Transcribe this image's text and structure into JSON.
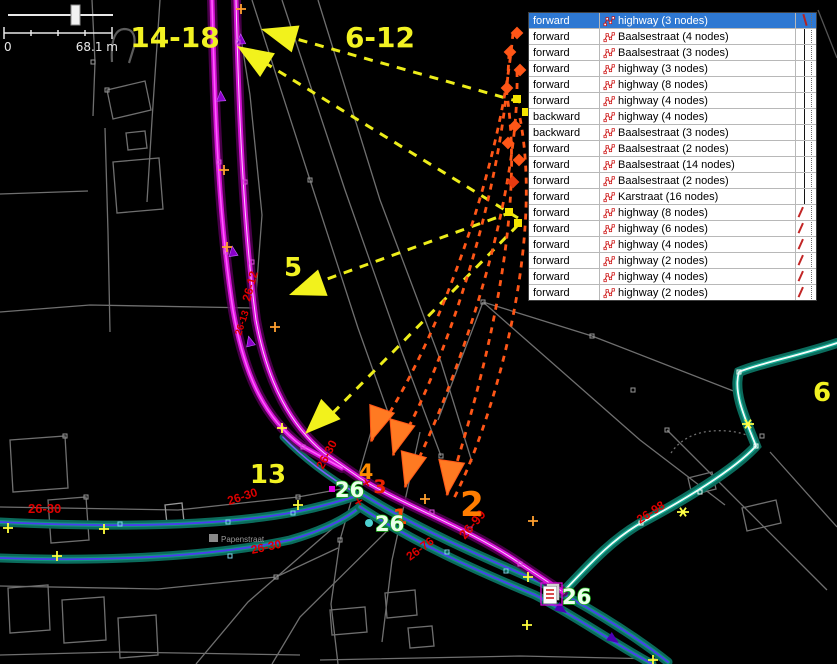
{
  "panel": {
    "rows": [
      {
        "role": "forward",
        "name": "highway (3 nodes)",
        "selected": true,
        "conn": "red"
      },
      {
        "role": "forward",
        "name": "Baalsestraat (4 nodes)",
        "selected": false,
        "conn": "v"
      },
      {
        "role": "forward",
        "name": "Baalsestraat (3 nodes)",
        "selected": false,
        "conn": "v"
      },
      {
        "role": "forward",
        "name": "highway (3 nodes)",
        "selected": false,
        "conn": "v"
      },
      {
        "role": "forward",
        "name": "highway (8 nodes)",
        "selected": false,
        "conn": "v"
      },
      {
        "role": "forward",
        "name": "highway (4 nodes)",
        "selected": false,
        "conn": "v"
      },
      {
        "role": "backward",
        "name": "highway (4 nodes)",
        "selected": false,
        "conn": "v"
      },
      {
        "role": "backward",
        "name": "Baalsestraat (3 nodes)",
        "selected": false,
        "conn": "v"
      },
      {
        "role": "forward",
        "name": "Baalsestraat (2 nodes)",
        "selected": false,
        "conn": "v"
      },
      {
        "role": "forward",
        "name": "Baalsestraat (14 nodes)",
        "selected": false,
        "conn": "v"
      },
      {
        "role": "forward",
        "name": "Baalsestraat (2 nodes)",
        "selected": false,
        "conn": "v"
      },
      {
        "role": "forward",
        "name": "Karstraat (16 nodes)",
        "selected": false,
        "conn": "end"
      },
      {
        "role": "forward",
        "name": "highway (8 nodes)",
        "selected": false,
        "conn": "diag"
      },
      {
        "role": "forward",
        "name": "highway (6 nodes)",
        "selected": false,
        "conn": "diag"
      },
      {
        "role": "forward",
        "name": "highway (4 nodes)",
        "selected": false,
        "conn": "diag"
      },
      {
        "role": "forward",
        "name": "highway (2 nodes)",
        "selected": false,
        "conn": "diag"
      },
      {
        "role": "forward",
        "name": "highway (4 nodes)",
        "selected": false,
        "conn": "diag"
      },
      {
        "role": "forward",
        "name": "highway (2 nodes)",
        "selected": false,
        "conn": "diag"
      }
    ]
  },
  "scalebar": {
    "zero": "0",
    "max": "68.1 m"
  },
  "labels": {
    "l14_18": "14-18",
    "l6_12": "6-12",
    "l5": "5",
    "l13": "13",
    "l6": "6",
    "n1": "1",
    "n2": "2",
    "n3": "3",
    "n4": "4"
  },
  "badges": {
    "b1": "26",
    "b2": "26",
    "b3": "26"
  },
  "street": "Papenstraat",
  "refs": {
    "r1": "26-12",
    "r2": "26-13",
    "r3": "26-30",
    "r4": "26-30",
    "r5": "26-30",
    "r6": "26-30",
    "r7": "26-76",
    "r8": "26-98",
    "r9": "26-99"
  },
  "marks": {
    "m1": "×",
    "m2": "×"
  },
  "colors": {
    "selection_blue": "#2e78d2",
    "magenta_road": "#ff5cff",
    "teal_road": "#0b6b5c",
    "violet_center": "#4b3df0",
    "callout_yellow": "#f2f21c",
    "callout_orange": "#ff5617",
    "badge_green": "#18b018",
    "ref_red": "#dd0000"
  }
}
